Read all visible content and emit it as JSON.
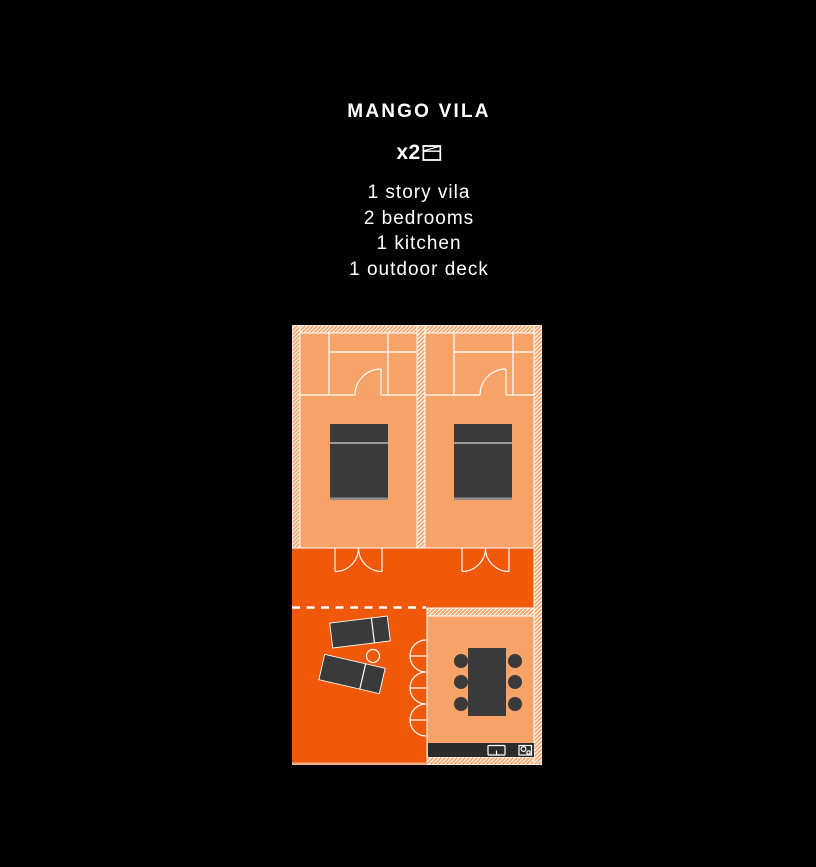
{
  "title": "MANGO VILA",
  "quantity": {
    "label": "x2",
    "icon": "floorplan-count-icon"
  },
  "features": [
    "1 story vila",
    "2 bedrooms",
    "1 kitchen",
    "1 outdoor deck"
  ],
  "colors": {
    "background": "#000000",
    "floor_light": "#F7A267",
    "deck_orange": "#F1580A",
    "line_white": "#FFFFFF",
    "furniture_dark": "#3A3A3A",
    "counter_dark": "#2B2B2B",
    "bed_pillow_line": "#999999",
    "bed_foot_line": "#8C8C8C",
    "text_white": "#FFFFFF",
    "deck_edge": "#F0AF85"
  }
}
